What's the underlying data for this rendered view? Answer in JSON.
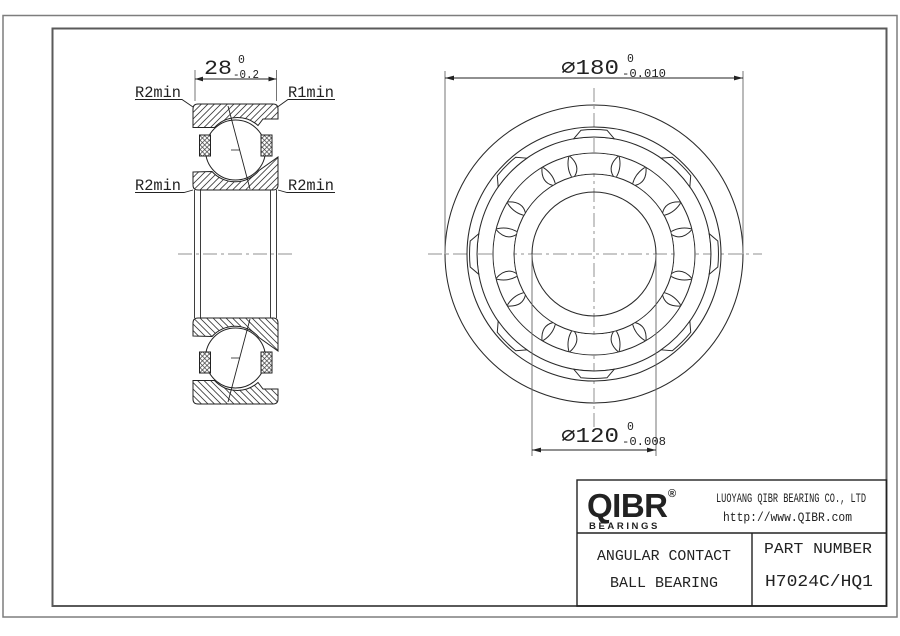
{
  "drawing": {
    "section_view": {
      "corner_labels": {
        "top_left": "R2min",
        "top_right": "R1min",
        "bottom_left": "R2min",
        "bottom_right": "R2min"
      },
      "width_dim": {
        "value": "28",
        "tol_upper": "0",
        "tol_lower": "-0.2"
      }
    },
    "front_view": {
      "outer_dia_dim": {
        "value": "⌀180",
        "tol_upper": "0",
        "tol_lower": "-0.010"
      },
      "bore_dia_dim": {
        "value": "⌀120",
        "tol_upper": "0",
        "tol_lower": "-0.008"
      }
    }
  },
  "title_block": {
    "logo": {
      "text": "QIBR",
      "registered": "®",
      "subtext": "BEARINGS"
    },
    "company": "LUOYANG QIBR BEARING CO., LTD",
    "website": "http://www.QIBR.com",
    "product_type_line1": "ANGULAR CONTACT",
    "product_type_line2": "BALL BEARING",
    "part_number_label": "PART NUMBER",
    "part_number": "H7024C/HQ1"
  },
  "colors": {
    "line": "#222222",
    "centerline": "#909090",
    "border": "#7d7d7d",
    "background": "#ffffff"
  }
}
